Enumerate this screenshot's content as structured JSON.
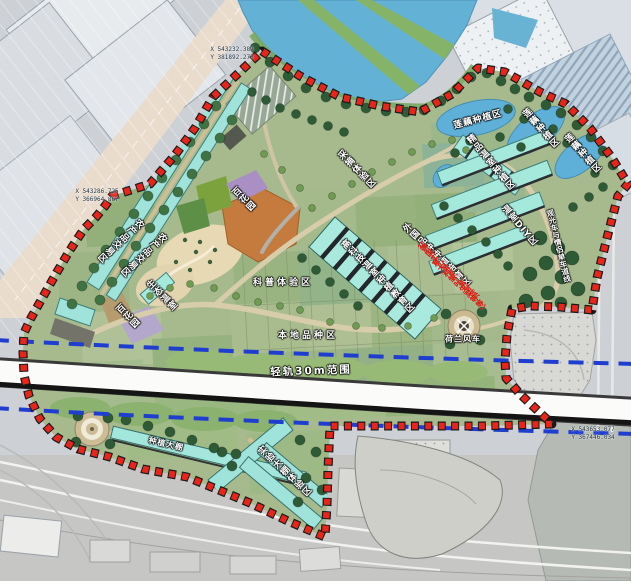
{
  "plan": {
    "labels": {
      "trade_a": "农产品交易区",
      "trade_b": "农产品交易区",
      "picking": "采摘体验区",
      "lotus_a": "莲藕种植区",
      "lotus_b": "莲藕种植区",
      "lotus_c": "莲藕种植区",
      "boutique_greenhouse": "精品温室种植区",
      "greenhouse_diy": "温室DIY区",
      "hightech_greenhouse": "高科技温室种植教育区",
      "science": "科普体验区",
      "local_species": "本地品种区",
      "flower_garden_a": "百花园",
      "flower_garden_b": "百花园",
      "eco_greenhouse": "生态温室",
      "foreign_species": "外国品种种植培育区",
      "foreign_note_1": "（德国实心黄芹、紫甘蓝、",
      "foreign_note_2": "意大利皱叶生菜等等）",
      "dutch_windmill": "荷兰风车",
      "tour_lane": "观光车与情侣单车道线",
      "light_rail": "轻轨30m范围",
      "planting_shed": "种植大棚",
      "experiment_shed": "实验大棚体验区"
    },
    "coordinates": [
      {
        "x": "X 543232.389",
        "y": "Y 381892.273"
      },
      {
        "x": "X 543286.725",
        "y": "Y 366964.867"
      },
      {
        "x": "X 543653.077",
        "y": "Y 367446.034"
      }
    ],
    "colors": {
      "boundary_red": "#e8251a",
      "corridor_blue": "#1f3ed0",
      "water_blue": "#64b1d6",
      "greenhouse_cyan": "#a5e8dc",
      "park_green": "#a6ba8e",
      "tree_green": "#2e5a36"
    }
  }
}
